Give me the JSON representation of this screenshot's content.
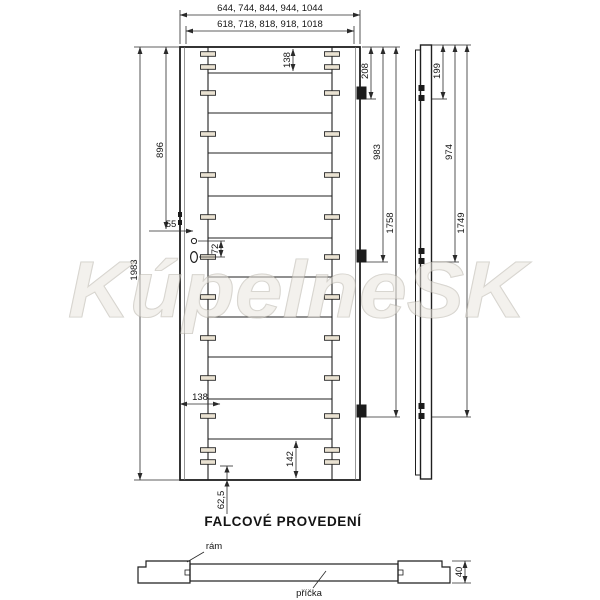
{
  "watermark_text": "KúpelneSK",
  "title": "FALCOVÉ PROVEDENÍ",
  "front_view": {
    "width_overall": "644, 744, 844, 944, 1044",
    "width_inner": "618, 718, 818, 918, 1018",
    "height_overall": "1983",
    "handle_height_from_top": "896",
    "top_rail": "138",
    "handle_edge_offset": "55",
    "handle_hole_spacing": "72",
    "bottom_stile_width": "138",
    "bottom_rail": "142",
    "bottom_dowel_offset": "62,5",
    "hinge_top": "208",
    "hinge_middle": "983",
    "hinge_bottom": "1758"
  },
  "side_view": {
    "hinge_top": "199",
    "hinge_middle": "974",
    "hinge_bottom": "1749"
  },
  "cross_section": {
    "frame_label": "rám",
    "slat_label": "příčka",
    "thickness": "40"
  },
  "colors": {
    "door_fill": "#eae2d2",
    "wood_frame_fill": "#d6c3a0",
    "wood_slat_fill": "#e7decb",
    "line": "#2a2a2a"
  }
}
